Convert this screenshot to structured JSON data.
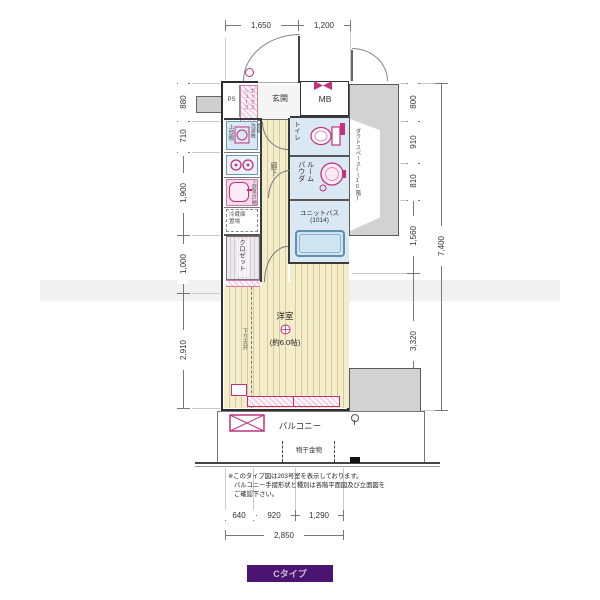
{
  "badge": {
    "label": "Cタイプ",
    "bg": "#4a1470"
  },
  "dims": {
    "top": [
      "1,650",
      "1,200"
    ],
    "left": [
      "880",
      "710",
      "1,900",
      "1,000",
      "2,910"
    ],
    "right": [
      "800",
      "910",
      "810",
      "1,560",
      "3,320",
      "1,400"
    ],
    "right_total": "7,400",
    "bottom": [
      "640",
      "920",
      "1,290"
    ],
    "bottom_total": "2,850"
  },
  "rooms": {
    "ps": "PS",
    "shoe_box": "シューズボックス",
    "entrance": "玄関",
    "mb": "MB",
    "toilet": "トイレ",
    "powder": "パウダルーム",
    "bath": "ユニットバス",
    "bath_size": "(1014)",
    "corridor": "廊下",
    "western": "洋室",
    "western_size": "(約6.0帖)",
    "closet": "クロゼット",
    "balcony": "バルコニー"
  },
  "fixtures": {
    "upper_shelf": "上部棚",
    "washer": "洗濯機置場",
    "upper_cabinet": "上部吊戸棚",
    "fridge": "冷蔵庫置場",
    "laundry": "物干金物",
    "lowered_ceiling": "下り天井",
    "duct_note": "ダクトスペース(〜10階)"
  },
  "notes": {
    "line1": "※このタイプ図は203号室を表示しております。",
    "line2": "バルコニー手摺形状と種別は各階平面図及び立面図を",
    "line3": "ご確認下さい。"
  }
}
